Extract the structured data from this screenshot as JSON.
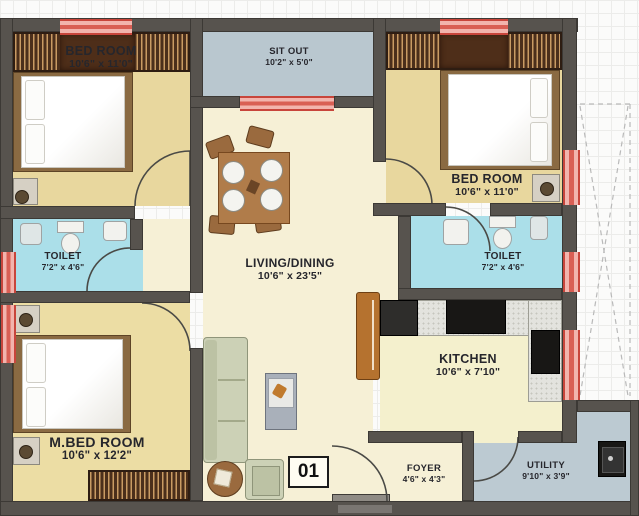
{
  "unit_label": "01",
  "rooms": {
    "bedroom_top_left": {
      "name": "BED ROOM",
      "dims": "10'6\" x 11'0\""
    },
    "sit_out": {
      "name": "SIT OUT",
      "dims": "10'2\" x 5'0\""
    },
    "bedroom_right": {
      "name": "BED ROOM",
      "dims": "10'6\" x 11'0\""
    },
    "toilet_left": {
      "name": "TOILET",
      "dims": "7'2\" x 4'6\""
    },
    "toilet_right": {
      "name": "TOILET",
      "dims": "7'2\" x 4'6\""
    },
    "living_dining": {
      "name": "LIVING/DINING",
      "dims": "10'6\" x 23'5\""
    },
    "kitchen": {
      "name": "KITCHEN",
      "dims": "10'6\" x 7'10\""
    },
    "master_bedroom": {
      "name": "M.BED ROOM",
      "dims": "10'6\" x 12'2\""
    },
    "foyer": {
      "name": "FOYER",
      "dims": "4'6\" x 4'3\""
    },
    "utility": {
      "name": "UTILITY",
      "dims": "9'10\" x 3'9\""
    }
  },
  "colors": {
    "wall": "#57534e",
    "window_red": "#c8453b",
    "window_pink": "#f2b4ad",
    "floor_bedroom": "#e8d79e",
    "floor_master_bedroom": "#ecdda4",
    "floor_living": "#f6f0d6",
    "floor_kitchen": "#f4f0cd",
    "floor_toilet": "#abdfe9",
    "floor_sitout": "#b9c7cf",
    "floor_utility": "#bccad2",
    "wardrobe_dark": "#4b2f1b",
    "wardrobe_stripe": "#c99b63",
    "wood": "#8a6a42",
    "sofa": "#ccd1b6",
    "counter": "#e3e3de",
    "appliance_black": "#181715"
  }
}
